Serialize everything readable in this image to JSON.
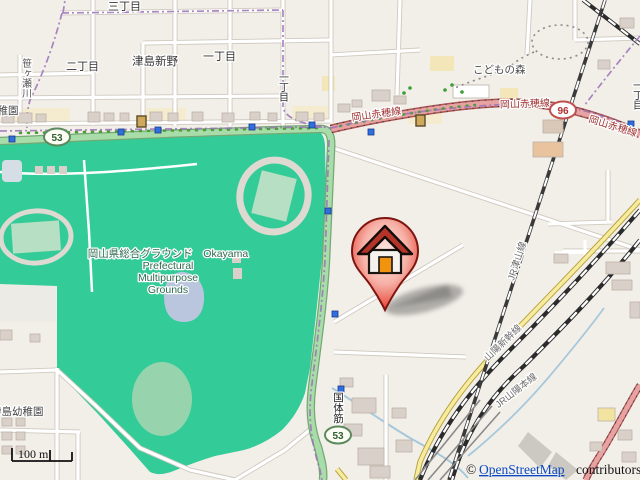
{
  "colors": {
    "background_beige": "#f2efe9",
    "park_green": "#33cc99",
    "pitch_green": "#97d4ad",
    "trunk_road_green": "#a8dca8",
    "primary_road_pink": "#e8a2a2",
    "secondary_road_yellow": "#f7ec9e",
    "boundary_purple": "#9c72b8",
    "water_blue": "#b9c6dd",
    "building_gray": "#d9d0c9",
    "marker_red": "#d42a1f",
    "bus_stop_blue": "#2f6fe0",
    "link_blue": "#0b49c4"
  },
  "labels": {
    "sanchome": "三丁目",
    "nichome": "二丁目",
    "tsushima_shinno": "津島新野",
    "itchome": "一丁目",
    "itchome_vertical_west": "一丁目",
    "itchome_vertical_east": "一丁目",
    "kodomo_no_mori": "こどもの森",
    "kindergarten_partial": "幼稚園",
    "ijima_kindergarten": "伊島幼稚園",
    "sasagase_river": "笹ヶ瀬川",
    "kokutai_suji": "国体筋"
  },
  "park": {
    "line1": "岡山県総合グラウンド　Okayama",
    "line2": "Prefectural",
    "line3": "Multipurpose",
    "line4": "Grounds"
  },
  "roads": {
    "akaho_line": "岡山赤穂線",
    "route53_ref": "53",
    "route96_ref": "96"
  },
  "railways": {
    "tsuyama_line": "JR津山線",
    "sanyo_shinkansen": "山陽新幹線",
    "sanyo_main_line": "JR山陽本線"
  },
  "scale_bar": {
    "label": "100 m"
  },
  "attribution": {
    "prefix": "©",
    "link_text": "OpenStreetMap",
    "suffix": "contributors"
  },
  "marker": {
    "name": "house-location-marker"
  }
}
